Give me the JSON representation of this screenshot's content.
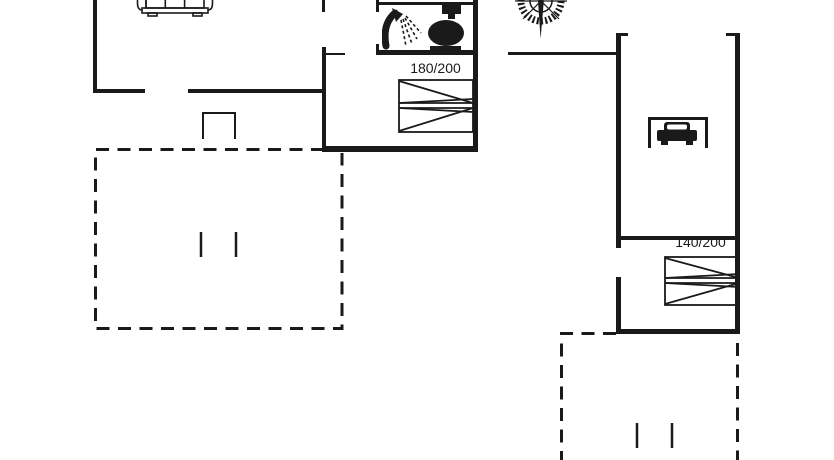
{
  "floorplan": {
    "colors": {
      "line": "#1a1a1a",
      "background": "#ffffff"
    },
    "labels": {
      "bed_large": "180/200",
      "bed_small": "140/200"
    },
    "icons": [
      {
        "name": "sofa-icon"
      },
      {
        "name": "shower-icon"
      },
      {
        "name": "toilet-icon"
      },
      {
        "name": "compass-icon"
      },
      {
        "name": "car-icon"
      }
    ]
  }
}
